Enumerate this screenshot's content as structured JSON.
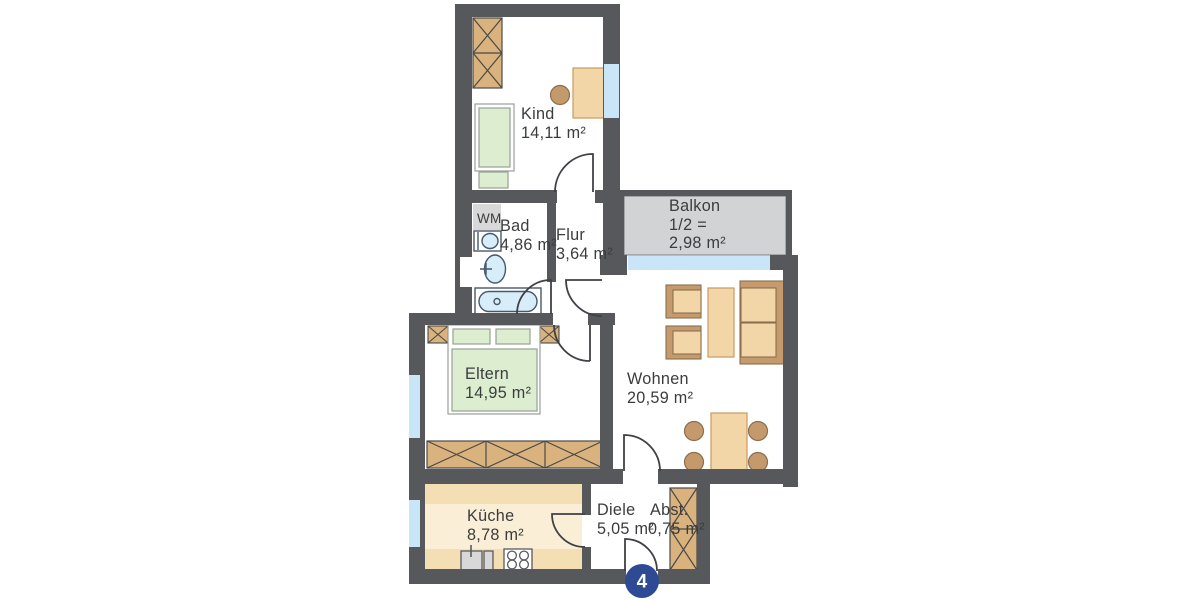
{
  "unit": {
    "badge": "4"
  },
  "appliances": {
    "washing_machine": "WM"
  },
  "rooms": {
    "kind": {
      "name": "Kind",
      "area": "14,11 m²"
    },
    "bad": {
      "name": "Bad",
      "area": "4,86 m²"
    },
    "flur": {
      "name": "Flur",
      "area": "3,64 m²"
    },
    "balkon": {
      "name": "Balkon",
      "share": "1/2 =",
      "area": "2,98 m²"
    },
    "eltern": {
      "name": "Eltern",
      "area": "14,95 m²"
    },
    "wohnen": {
      "name": "Wohnen",
      "area": "20,59 m²"
    },
    "kueche": {
      "name": "Küche",
      "area": "8,78 m²"
    },
    "diele": {
      "name": "Diele",
      "area": "5,05 m²"
    },
    "abst": {
      "name": "Abst.",
      "area": "0,75 m²"
    }
  },
  "colors": {
    "wall": "#57585b",
    "window": "#c9e6f8",
    "balcony": "#d2d3d4",
    "furniture_tan": "#f2d6a8",
    "counter_tan": "#f4dfb5",
    "kitchen_floor": "#fbeed7",
    "wood": "#d9b27e",
    "sofa_frame": "#c59b6d",
    "chair_brown": "#c49a6c",
    "bed_green": "#ddeed0",
    "water_blue": "#d8edfa",
    "appliance_gray": "#d8d8d8",
    "door_line": "#3f4146",
    "text": "#3b3c3e",
    "badge_blue": "#2e4a95"
  }
}
